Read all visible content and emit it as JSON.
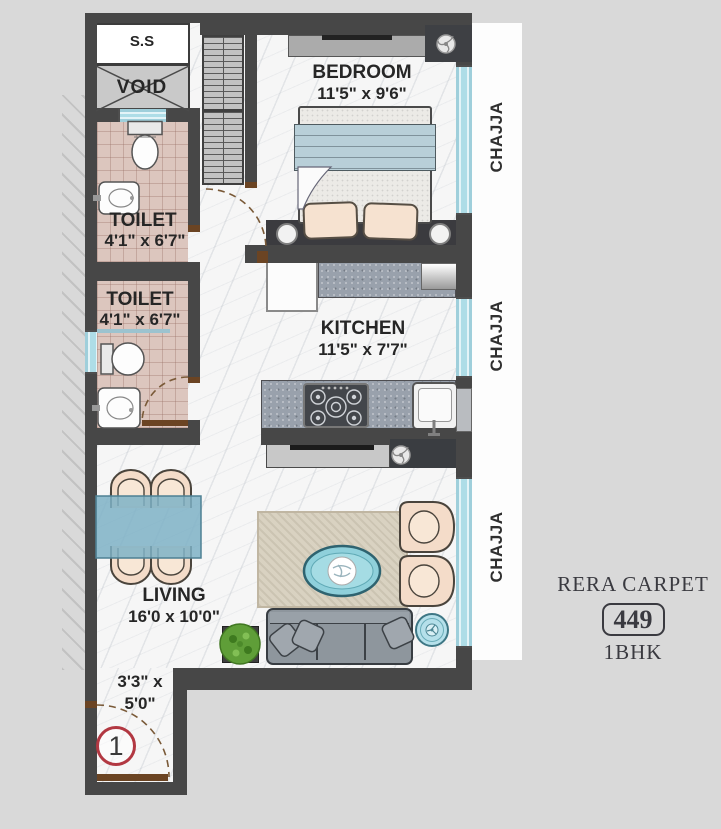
{
  "plan": {
    "rooms": {
      "shaft": {
        "label": "S.S"
      },
      "void": {
        "label": "VOID"
      },
      "bedroom": {
        "name": "BEDROOM",
        "size": "11'5\" x 9'6\""
      },
      "toilet_top": {
        "name": "TOILET",
        "size": "4'1\" x 6'7\""
      },
      "toilet_bottom": {
        "name": "TOILET",
        "size": "4'1\" x 6'7\""
      },
      "kitchen": {
        "name": "KITCHEN",
        "size": "11'5\" x 7'7\""
      },
      "living": {
        "name": "LIVING",
        "size": "16'0 x 10'0\""
      },
      "entry": {
        "size_line1": "3'3\" x",
        "size_line2": "5'0\""
      }
    },
    "chajja_labels": [
      "CHAJJA",
      "CHAJJA",
      "CHAJJA"
    ],
    "unit_number": "1",
    "legend": {
      "title": "RERA CARPET",
      "carpet_area": "449",
      "unit_type": "1BHK"
    },
    "icons": {
      "ceiling_fan": "circle-with-curved-blades",
      "door_swing": "dashed-quarter-arc",
      "void_cross": "x-diagonals"
    },
    "colors": {
      "background": "#d9d9d9",
      "wall": "#474747",
      "window_blue": "#aedde7",
      "toilet_tile": "#dcc6be",
      "counter_granite": "#99a1ac",
      "dining_table_blue": "#7eb1c5",
      "sofa_gray": "#8e969d",
      "chair_peach": "#f4dcc9",
      "rug_beige": "#d9d2c1",
      "plant_green": "#5f9e38",
      "door_brown": "#6b4423",
      "unit_circle_red": "#b23842",
      "text_dark": "#2b2b2b"
    }
  }
}
